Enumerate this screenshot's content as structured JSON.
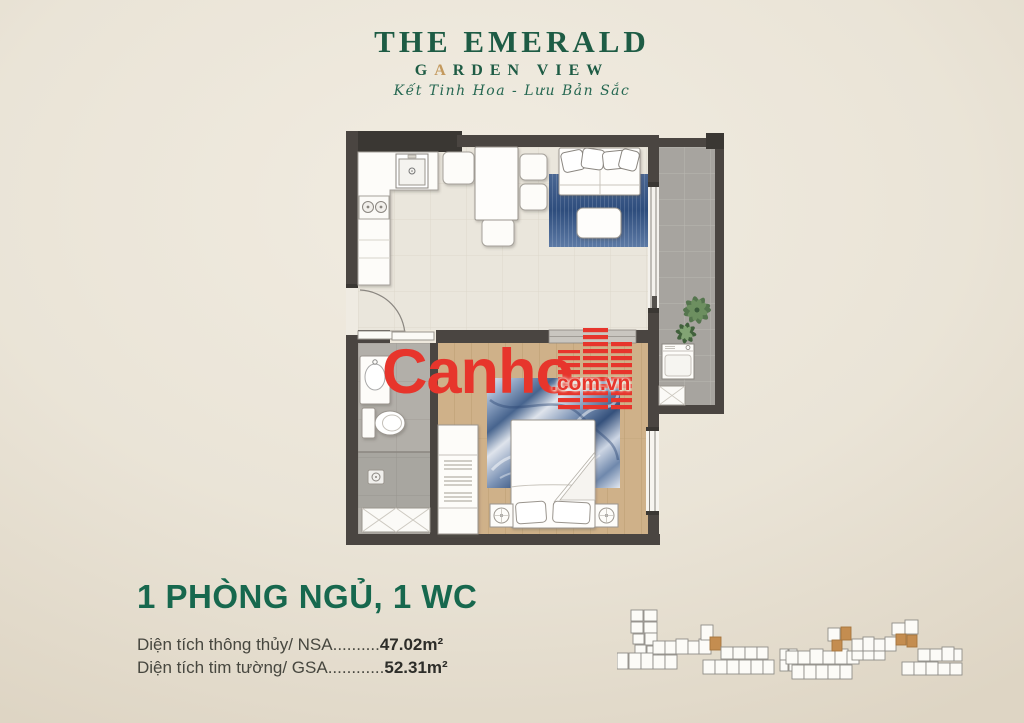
{
  "colors": {
    "green": "#1e5c45",
    "heading-green": "#17684e",
    "gold": "#c3995d",
    "red": "#e7352c",
    "wall": "#4a4541",
    "wood-floor": "#cfb189",
    "background": "#eae4d7",
    "keyplan-highlight": "#c48d50"
  },
  "brand": {
    "title": "THE EMERALD",
    "subtitle_g": "G",
    "subtitle_a": "A",
    "subtitle_rest": "RDEN VIEW",
    "tagline": "Kết Tinh Hoa - Lưu Bản Sắc"
  },
  "watermark": {
    "name": "Canho",
    "domain": ".com.vn"
  },
  "unit_info": {
    "title": "1 PHÒNG NGỦ, 1 WC",
    "rows": [
      {
        "label": "Diện tích thông thủy/ NSA",
        "dots": "..........",
        "value": "47.02m²"
      },
      {
        "label": "Diện tích tim tường/ GSA",
        "dots": "............",
        "value": "52.31m²"
      }
    ]
  },
  "key_plans": {
    "highlight_color": "#c48d50",
    "left": {
      "units": [
        [
          14,
          14,
          12,
          11,
          0
        ],
        [
          27,
          14,
          13,
          11,
          0
        ],
        [
          14,
          26,
          12,
          11,
          0
        ],
        [
          27,
          26,
          13,
          11,
          0
        ],
        [
          16,
          38,
          11,
          10,
          0
        ],
        [
          28,
          37,
          12,
          12,
          0
        ],
        [
          18,
          49,
          11,
          10,
          0
        ],
        [
          30,
          50,
          11,
          10,
          0
        ],
        [
          0,
          57,
          11,
          16,
          0
        ],
        [
          12,
          57,
          12,
          16,
          0
        ],
        [
          24,
          57,
          12,
          16,
          0
        ],
        [
          36,
          59,
          12,
          14,
          0
        ],
        [
          48,
          59,
          12,
          14,
          0
        ],
        [
          36,
          45,
          12,
          13,
          0
        ],
        [
          48,
          45,
          11,
          13,
          0
        ],
        [
          59,
          43,
          12,
          15,
          0
        ],
        [
          71,
          45,
          11,
          13,
          0
        ],
        [
          82,
          43,
          12,
          15,
          0
        ],
        [
          84,
          29,
          12,
          15,
          0
        ],
        [
          93,
          41,
          11,
          13,
          1
        ],
        [
          104,
          51,
          12,
          12,
          0
        ],
        [
          116,
          51,
          12,
          12,
          0
        ],
        [
          128,
          51,
          12,
          12,
          0
        ],
        [
          140,
          51,
          11,
          12,
          0
        ],
        [
          86,
          64,
          12,
          14,
          0
        ],
        [
          98,
          64,
          12,
          14,
          0
        ],
        [
          110,
          64,
          12,
          14,
          0
        ],
        [
          122,
          64,
          12,
          14,
          0
        ],
        [
          134,
          64,
          12,
          14,
          0
        ],
        [
          146,
          64,
          11,
          14,
          0
        ],
        [
          163,
          53,
          8,
          11,
          0
        ],
        [
          172,
          53,
          8,
          11,
          0
        ],
        [
          163,
          64,
          8,
          11,
          0
        ],
        [
          172,
          64,
          8,
          11,
          0
        ]
      ]
    },
    "right": {
      "units": [
        [
          4,
          55,
          12,
          13,
          0
        ],
        [
          16,
          55,
          12,
          13,
          0
        ],
        [
          28,
          53,
          13,
          15,
          0
        ],
        [
          41,
          55,
          12,
          13,
          0
        ],
        [
          53,
          53,
          13,
          15,
          0
        ],
        [
          65,
          55,
          12,
          13,
          0
        ],
        [
          10,
          69,
          12,
          14,
          0
        ],
        [
          22,
          69,
          12,
          14,
          0
        ],
        [
          34,
          69,
          12,
          14,
          0
        ],
        [
          46,
          69,
          12,
          14,
          0
        ],
        [
          58,
          69,
          12,
          14,
          0
        ],
        [
          46,
          32,
          12,
          13,
          0
        ],
        [
          50,
          44,
          10,
          11,
          1
        ],
        [
          59,
          31,
          10,
          13,
          1
        ],
        [
          70,
          43,
          11,
          12,
          0
        ],
        [
          81,
          41,
          11,
          14,
          0
        ],
        [
          92,
          43,
          11,
          12,
          0
        ],
        [
          81,
          55,
          11,
          9,
          0
        ],
        [
          92,
          55,
          11,
          9,
          0
        ],
        [
          103,
          41,
          11,
          14,
          0
        ],
        [
          70,
          55,
          11,
          9,
          0
        ],
        [
          110,
          27,
          13,
          12,
          0
        ],
        [
          123,
          24,
          13,
          14,
          0
        ],
        [
          114,
          38,
          10,
          11,
          1
        ],
        [
          125,
          39,
          10,
          12,
          1
        ],
        [
          136,
          53,
          12,
          12,
          0
        ],
        [
          148,
          53,
          12,
          12,
          0
        ],
        [
          160,
          51,
          12,
          14,
          0
        ],
        [
          172,
          53,
          8,
          12,
          0
        ],
        [
          120,
          66,
          12,
          13,
          0
        ],
        [
          132,
          66,
          12,
          13,
          0
        ],
        [
          144,
          66,
          12,
          13,
          0
        ],
        [
          156,
          67,
          12,
          12,
          0
        ],
        [
          168,
          67,
          12,
          12,
          0
        ]
      ]
    }
  }
}
